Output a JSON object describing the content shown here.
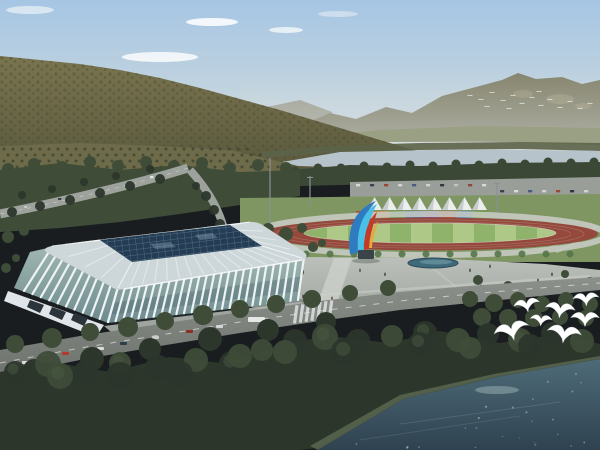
{
  "meta": {
    "description": "Aerial architectural rendering of a lakeside sports complex: white ribbed stadium with dark glass roof, athletics track with colorful stands and white tents, plaza with colorful sculpture, forested mountains, river, boulevard and flying egrets",
    "width": 600,
    "height": 450
  },
  "palette": {
    "sky_top": "#a6c6e4",
    "sky_mid": "#c3d4de",
    "sky_horizon": "#dadfe0",
    "cloud": "#ffffff",
    "ridge_far": "#9b9b8b",
    "ridge_right": "#85846d",
    "ridge_bare": "#a8a284",
    "hill_top": "#7a744f",
    "hill_base": "#59573c",
    "orchard": "#6e6b4b",
    "orchard_dot": "#3d4430",
    "valley": "#9aa083",
    "far_trees": "#5c6348",
    "river": "#b6c3ca",
    "bank_trees": "#3c4836",
    "parking": "#999e98",
    "lawn": "#7f9663",
    "infield_a": "#8fb36a",
    "infield_b": "#aec887",
    "track": "#94493c",
    "track_line": "#b08578",
    "walkway": "#c6cac2",
    "tent": "#eceeee",
    "tent_shade": "#c2c8cc",
    "tree_dark": "#2c362b",
    "tree_mid": "#3e4c38",
    "tree_bright": "#55754a",
    "road": "#787d78",
    "road_light": "#9da29c",
    "plaza": "#b3b7b2",
    "plaza_path": "#cdd1cb",
    "pond": "#3f6a7a",
    "pond_light": "#7aa2ae",
    "rib": "#eef3f4",
    "roof_rim": "#cdd7da",
    "roof_glass": "#243d55",
    "entrance": "#dfe5e8",
    "entrance_dark": "#2a343a",
    "sculpture_blue": "#2f7bc0",
    "sculpture_cyan": "#49c0e8",
    "sculpture_red": "#c23a28",
    "sculpture_yellow": "#e8a83a",
    "sculpture_base": "#3a4448",
    "water_glint": "#a8bcbe",
    "bird": "#ffffff",
    "people": "#3a3f45",
    "pole": "#8a9094",
    "shadow": "#2f3a36",
    "grey_block": "#9aa0a2"
  },
  "scene": {
    "clouds": [
      {
        "x": 212,
        "y": 22,
        "rx": 26,
        "ry": 4,
        "o": 0.85
      },
      {
        "x": 160,
        "y": 57,
        "rx": 38,
        "ry": 5,
        "o": 0.8
      },
      {
        "x": 286,
        "y": 30,
        "rx": 17,
        "ry": 3,
        "o": 0.7
      },
      {
        "x": 30,
        "y": 10,
        "rx": 24,
        "ry": 4,
        "o": 0.55
      },
      {
        "x": 338,
        "y": 14,
        "rx": 20,
        "ry": 3,
        "o": 0.4
      }
    ],
    "tents": {
      "count": 8,
      "x0": 367,
      "dx": 15,
      "peak_y": 197,
      "base_y": 210,
      "w": 15
    },
    "containers": {
      "y": 211,
      "h": 7,
      "blocks": [
        {
          "x": 356,
          "w": 17,
          "c": "#b4502f"
        },
        {
          "x": 373,
          "w": 16,
          "c": "#c8883a"
        },
        {
          "x": 389,
          "w": 17,
          "c": "#55973f"
        },
        {
          "x": 406,
          "w": 17,
          "c": "#3a66b8"
        },
        {
          "x": 423,
          "w": 16,
          "c": "#7e52ae"
        },
        {
          "x": 439,
          "w": 17,
          "c": "#b8452f"
        },
        {
          "x": 456,
          "w": 16,
          "c": "#3f88c0"
        },
        {
          "x": 472,
          "w": 16,
          "c": "#6f9e3f"
        }
      ]
    },
    "track": {
      "cx": 430,
      "cy": 234,
      "rx": 168,
      "ry": 16.5,
      "inner_rx": 126,
      "inner_ry": 10,
      "stripe_x0": 306,
      "stripe_w": 21,
      "stripes": 12
    },
    "white_boxes": [
      [
        542,
        204,
        9,
        5
      ],
      [
        556,
        206,
        8,
        4
      ]
    ],
    "grey_block": [
      338,
      206,
      16,
      10
    ],
    "poles": [
      {
        "x": 270,
        "y1": 158,
        "y2": 234,
        "arm": 0
      },
      {
        "x": 310,
        "y1": 176,
        "y2": 206,
        "arm": 1
      },
      {
        "x": 497,
        "y1": 182,
        "y2": 212,
        "arm": 1
      }
    ],
    "upper_cars": [
      {
        "x": 150,
        "y": 176,
        "c": "#e8eaea"
      },
      {
        "x": 96,
        "y": 189,
        "c": "#d8dada"
      },
      {
        "x": 58,
        "y": 198,
        "c": "#2f3a42"
      },
      {
        "x": 24,
        "y": 206,
        "c": "#c8cccc"
      }
    ],
    "parking_cars": [
      {
        "x": 356,
        "y": 184,
        "c": "#d8dcdc"
      },
      {
        "x": 370,
        "y": 184,
        "c": "#39434d"
      },
      {
        "x": 384,
        "y": 184,
        "c": "#9a4536"
      },
      {
        "x": 398,
        "y": 184,
        "c": "#d0d4d4"
      },
      {
        "x": 412,
        "y": 184,
        "c": "#4a5a84"
      },
      {
        "x": 426,
        "y": 184,
        "c": "#cfd3d3"
      },
      {
        "x": 440,
        "y": 184,
        "c": "#2e3840"
      },
      {
        "x": 454,
        "y": 184,
        "c": "#c0c4c4"
      },
      {
        "x": 468,
        "y": 184,
        "c": "#8a4a3a"
      },
      {
        "x": 482,
        "y": 184,
        "c": "#d8d8d8"
      },
      {
        "x": 500,
        "y": 190,
        "c": "#39434d"
      },
      {
        "x": 514,
        "y": 190,
        "c": "#d8dcdc"
      },
      {
        "x": 528,
        "y": 190,
        "c": "#4a5a84"
      },
      {
        "x": 542,
        "y": 190,
        "c": "#cfd3d3"
      },
      {
        "x": 556,
        "y": 190,
        "c": "#9a4536"
      },
      {
        "x": 570,
        "y": 190,
        "c": "#2e3840"
      },
      {
        "x": 584,
        "y": 190,
        "c": "#d0d4d4"
      }
    ],
    "blvd_cars": [
      {
        "x": 22,
        "y": 361,
        "c": "#dcdede"
      },
      {
        "x": 40,
        "y": 364,
        "c": "#2f3840"
      },
      {
        "x": 62,
        "y": 352,
        "c": "#b23a2c"
      },
      {
        "x": 97,
        "y": 347,
        "c": "#dadcdc"
      },
      {
        "x": 120,
        "y": 342,
        "c": "#2c3c48"
      },
      {
        "x": 152,
        "y": 336,
        "c": "#c9cdc9"
      },
      {
        "x": 186,
        "y": 330,
        "c": "#8e2f26"
      },
      {
        "x": 216,
        "y": 325,
        "c": "#d2d6d6"
      }
    ],
    "bus": {
      "x": 248,
      "y": 317,
      "w": 17,
      "h": 5,
      "c": "#e6e8e8"
    },
    "people": [
      [
        332,
        300
      ],
      [
        341,
        303
      ],
      [
        352,
        306
      ],
      [
        372,
        305
      ],
      [
        385,
        300
      ],
      [
        398,
        296
      ],
      [
        412,
        301
      ],
      [
        428,
        304
      ],
      [
        303,
        298
      ],
      [
        314,
        296
      ],
      [
        450,
        296
      ],
      [
        468,
        292
      ],
      [
        481,
        288
      ],
      [
        495,
        293
      ],
      [
        510,
        286
      ],
      [
        522,
        290
      ],
      [
        538,
        282
      ],
      [
        470,
        272
      ],
      [
        490,
        268
      ],
      [
        385,
        276
      ],
      [
        360,
        272
      ],
      [
        552,
        276
      ],
      [
        287,
        292
      ],
      [
        272,
        286
      ]
    ],
    "track_edge_trees": {
      "x0": 306,
      "dx": 24,
      "count": 12,
      "y": 254,
      "r": 3.5
    },
    "plaza_trees": [
      [
        250,
        288,
        5
      ],
      [
        282,
        296,
        5
      ],
      [
        355,
        306,
        5
      ],
      [
        300,
        272,
        4
      ],
      [
        262,
        272,
        4
      ],
      [
        478,
        280,
        5
      ],
      [
        508,
        286,
        5
      ],
      [
        540,
        292,
        5
      ],
      [
        565,
        274,
        4
      ],
      [
        590,
        282,
        5
      ],
      [
        438,
        294,
        5
      ],
      [
        408,
        300,
        5
      ]
    ],
    "back_trees": [
      [
        250,
        232,
        7
      ],
      [
        268,
        229,
        6
      ],
      [
        286,
        234,
        7
      ],
      [
        302,
        228,
        5
      ],
      [
        8,
        237,
        6
      ],
      [
        24,
        231,
        5
      ],
      [
        313,
        247,
        5
      ],
      [
        322,
        243,
        4
      ],
      [
        6,
        268,
        5
      ],
      [
        16,
        258,
        4
      ]
    ],
    "road_trees": [
      [
        160,
        179,
        5
      ],
      [
        130,
        186,
        5
      ],
      [
        100,
        193,
        5
      ],
      [
        70,
        200,
        5
      ],
      [
        40,
        206,
        5
      ],
      [
        12,
        212,
        5
      ],
      [
        150,
        169,
        4
      ],
      [
        116,
        176,
        4
      ],
      [
        84,
        182,
        4
      ],
      [
        52,
        189,
        4
      ],
      [
        22,
        195,
        4
      ],
      [
        206,
        196,
        5
      ],
      [
        214,
        210,
        5
      ],
      [
        220,
        224,
        5
      ],
      [
        196,
        186,
        4
      ]
    ],
    "mid_bumps": [
      [
        8,
        169
      ],
      [
        34,
        164
      ],
      [
        62,
        167
      ],
      [
        90,
        162
      ],
      [
        118,
        166
      ],
      [
        146,
        162
      ],
      [
        174,
        166
      ],
      [
        202,
        163
      ],
      [
        230,
        168
      ],
      [
        258,
        165
      ],
      [
        286,
        168
      ]
    ],
    "bank_bumps": [
      [
        295,
        171
      ],
      [
        318,
        168
      ],
      [
        341,
        168
      ],
      [
        364,
        166
      ],
      [
        387,
        167
      ],
      [
        410,
        165
      ],
      [
        433,
        166
      ],
      [
        456,
        164
      ],
      [
        479,
        165
      ],
      [
        502,
        163
      ],
      [
        525,
        164
      ],
      [
        548,
        162
      ],
      [
        571,
        163
      ],
      [
        594,
        162
      ]
    ],
    "blvd_trees_upper": [
      [
        15,
        344,
        9
      ],
      [
        52,
        338,
        10
      ],
      [
        90,
        332,
        9
      ],
      [
        128,
        327,
        10
      ],
      [
        165,
        321,
        9
      ],
      [
        203,
        315,
        10
      ],
      [
        240,
        309,
        9
      ],
      [
        276,
        304,
        9
      ],
      [
        312,
        299,
        9
      ],
      [
        350,
        293,
        8
      ],
      [
        388,
        288,
        8
      ]
    ],
    "blvd_trees_lower": [
      [
        34,
        370,
        11
      ],
      [
        92,
        359,
        12
      ],
      [
        150,
        349,
        11
      ],
      [
        210,
        339,
        12
      ],
      [
        268,
        330,
        11
      ],
      [
        326,
        322,
        10
      ]
    ],
    "right_trees": [
      [
        470,
        299,
        8
      ],
      [
        494,
        303,
        9
      ],
      [
        518,
        300,
        8
      ],
      [
        542,
        304,
        8
      ],
      [
        566,
        300,
        8
      ],
      [
        590,
        304,
        8
      ],
      [
        482,
        317,
        9
      ],
      [
        508,
        318,
        9
      ],
      [
        534,
        318,
        9
      ],
      [
        560,
        317,
        8
      ],
      [
        586,
        318,
        8
      ]
    ],
    "fg_bumps": [
      [
        15,
        372,
        11
      ],
      [
        48,
        364,
        13
      ],
      [
        85,
        373,
        12
      ],
      [
        120,
        363,
        11
      ],
      [
        158,
        368,
        13
      ],
      [
        196,
        360,
        12
      ],
      [
        232,
        364,
        13
      ],
      [
        262,
        350,
        11
      ],
      [
        295,
        341,
        12
      ],
      [
        325,
        337,
        13
      ],
      [
        358,
        341,
        12
      ],
      [
        392,
        336,
        11
      ],
      [
        425,
        333,
        12
      ],
      [
        458,
        340,
        12
      ],
      [
        488,
        334,
        11
      ],
      [
        520,
        340,
        12
      ],
      [
        552,
        333,
        11
      ],
      [
        582,
        341,
        12
      ],
      [
        345,
        352,
        14
      ],
      [
        240,
        356,
        12
      ],
      [
        120,
        376,
        14
      ],
      [
        60,
        376,
        13
      ],
      [
        180,
        374,
        13
      ],
      [
        285,
        352,
        12
      ],
      [
        420,
        344,
        12
      ],
      [
        470,
        348,
        11
      ],
      [
        530,
        346,
        12
      ]
    ],
    "birds_far": [
      [
        470,
        96
      ],
      [
        481,
        100
      ],
      [
        492,
        93
      ],
      [
        503,
        101
      ],
      [
        513,
        96
      ],
      [
        522,
        104
      ],
      [
        532,
        98
      ],
      [
        541,
        106
      ],
      [
        550,
        100
      ],
      [
        560,
        108
      ],
      [
        570,
        102
      ],
      [
        580,
        109
      ],
      [
        590,
        104
      ],
      [
        539,
        92
      ],
      [
        509,
        109
      ],
      [
        487,
        107
      ]
    ],
    "birds_near": [
      {
        "x": 527,
        "y": 306,
        "s": 1.0,
        "r": -10
      },
      {
        "x": 560,
        "y": 311,
        "s": 1.15,
        "r": 6
      },
      {
        "x": 586,
        "y": 300,
        "s": 1.0,
        "r": -4
      },
      {
        "x": 512,
        "y": 332,
        "s": 1.35,
        "r": -14
      },
      {
        "x": 564,
        "y": 335,
        "s": 1.3,
        "r": 8
      },
      {
        "x": 585,
        "y": 320,
        "s": 1.1,
        "r": 0
      },
      {
        "x": 541,
        "y": 321,
        "s": 0.85,
        "r": 4
      }
    ]
  }
}
